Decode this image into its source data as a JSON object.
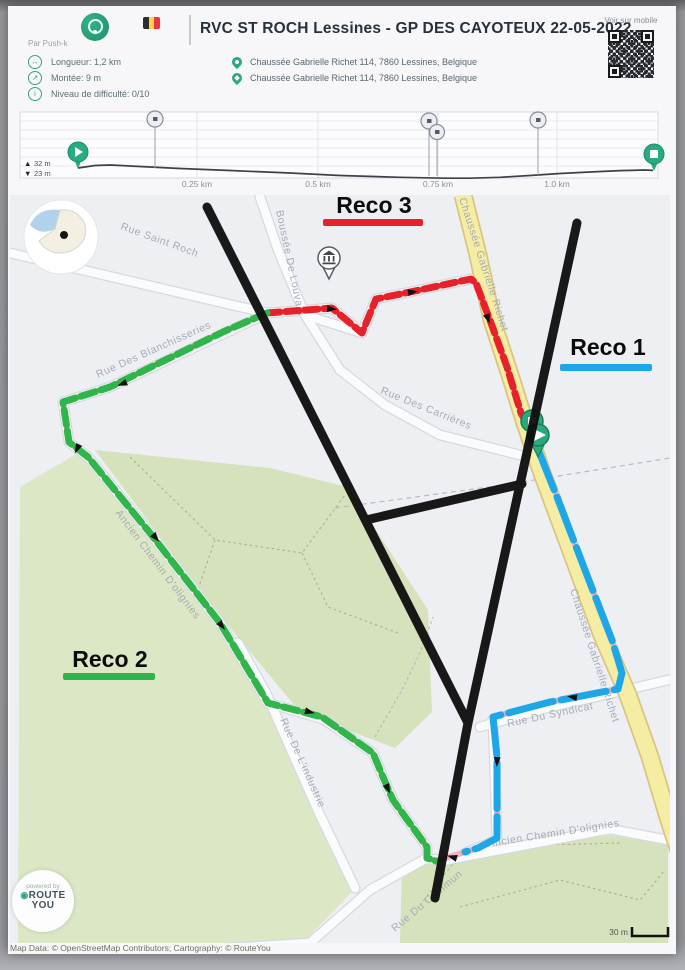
{
  "header": {
    "title": "RVC ST ROCH Lessines - GP DES CAYOTEUX 22-05-2022",
    "author": "Par Push-k",
    "stats": [
      {
        "icon": "distance-icon",
        "glyph": "↔",
        "label": "Longueur: 1,2 km"
      },
      {
        "icon": "climb-icon",
        "glyph": "↗",
        "label": "Montée: 9 m"
      },
      {
        "icon": "difficulty-icon",
        "glyph": "i",
        "label": "Niveau de difficulté: 0/10"
      }
    ],
    "addresses": [
      "Chaussée Gabrielle Richet 114, 7860 Lessines, Belgique",
      "Chaussée Gabrielle Richet 114, 7860 Lessines, Belgique"
    ],
    "qr_label": "Voir sur mobile"
  },
  "elevation": {
    "up_icon": "▲",
    "down_icon": "▼",
    "max_label": "32 m",
    "min_label": "23 m",
    "ticks": [
      "0.25 km",
      "0.5 km",
      "0.75 km",
      "1.0 km"
    ]
  },
  "map": {
    "recos": [
      {
        "label": "Reco 1",
        "color": "#1ea7e8"
      },
      {
        "label": "Reco 2",
        "color": "#2fb54a"
      },
      {
        "label": "Reco 3",
        "color": "#e62129"
      }
    ],
    "streets": [
      "Rue Saint Roch",
      "Rue Des Blanchisseries",
      "Boussée De Louvain",
      "Chaussée Gabrielle Richet",
      "Rue Des Carrières",
      "Ancien Chemin D'olignies",
      "Rue De L'industrie",
      "Rue Du Syndicat",
      "Rue Du Commun"
    ],
    "scale_label": "30 m"
  },
  "logo": {
    "powered_by": "powered by",
    "route": "ROUTE",
    "you": "YOU"
  },
  "footer": {
    "text": "Map Data: © OpenStreetMap Contributors; Cartography: © RouteYou"
  },
  "chart_data": {
    "type": "line",
    "title": "Elevation profile",
    "x_unit": "km",
    "y_unit": "m",
    "x": [
      0,
      0.05,
      0.1,
      0.2,
      0.3,
      0.4,
      0.5,
      0.6,
      0.7,
      0.75,
      0.8,
      0.9,
      1.0,
      1.1,
      1.2
    ],
    "y": [
      26,
      27,
      26.8,
      26.3,
      25.8,
      25.2,
      24.6,
      24.0,
      23.4,
      23.1,
      23.3,
      24.1,
      24.9,
      25.4,
      25.6
    ],
    "max_altitude_label": "32 m",
    "min_altitude_label": "23 m",
    "x_ticks": [
      "0.25 km",
      "0.5 km",
      "0.75 km",
      "1.0 km"
    ],
    "poi_positions_km": [
      0.2,
      0.72,
      0.75,
      1.0
    ],
    "start_km": 0,
    "end_km": 1.2,
    "grid": true,
    "legend": false
  }
}
